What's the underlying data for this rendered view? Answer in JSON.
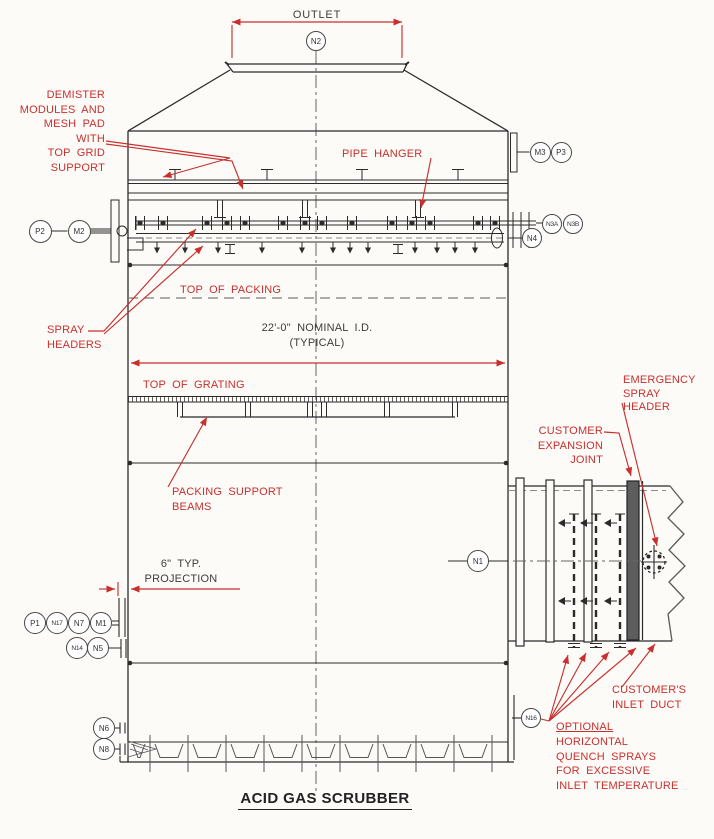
{
  "title": "ACID GAS SCRUBBER",
  "labels": {
    "outlet": "OUTLET",
    "demister": "DEMISTER\nMODULES AND\nMESH PAD\nWITH\nTOP GRID\nSUPPORT",
    "pipe_hanger": "PIPE HANGER",
    "top_of_packing": "TOP OF PACKING",
    "spray_headers": "SPRAY\nHEADERS",
    "nominal_id": "22'-0\" NOMINAL I.D.",
    "typical": "(TYPICAL)",
    "top_of_grating": "TOP OF GRATING",
    "packing_support_beams": "PACKING SUPPORT\nBEAMS",
    "projection": "6\" TYP.\nPROJECTION",
    "emergency_spray_header": "EMERGENCY\nSPRAY\nHEADER",
    "customer_expansion_joint": "CUSTOMER\nEXPANSION\nJOINT",
    "customers_inlet_duct": "CUSTOMER'S\nINLET DUCT",
    "optional_title": "OPTIONAL",
    "optional_rest": "HORIZONTAL\nQUENCH SPRAYS\nFOR EXCESSIVE\nINLET TEMPERATURE"
  },
  "nozzle_tags": [
    {
      "id": "N2",
      "x": 316,
      "y": 41,
      "r": 10
    },
    {
      "id": "M3",
      "x": 540,
      "y": 152,
      "r": 10.5
    },
    {
      "id": "P3",
      "x": 561,
      "y": 152,
      "r": 10.5
    },
    {
      "id": "P2",
      "x": 40,
      "y": 231,
      "r": 11.5
    },
    {
      "id": "M2",
      "x": 79,
      "y": 231,
      "r": 11.5
    },
    {
      "id": "N3A",
      "x": 552,
      "y": 224,
      "r": 10
    },
    {
      "id": "N3B",
      "x": 573,
      "y": 224,
      "r": 10
    },
    {
      "id": "N4",
      "x": 532,
      "y": 238,
      "r": 10
    },
    {
      "id": "N1",
      "x": 478,
      "y": 561,
      "r": 11
    },
    {
      "id": "P1",
      "x": 35,
      "y": 623,
      "r": 11
    },
    {
      "id": "N17",
      "x": 57,
      "y": 623,
      "r": 11
    },
    {
      "id": "N7",
      "x": 79,
      "y": 623,
      "r": 11
    },
    {
      "id": "M1",
      "x": 101,
      "y": 623,
      "r": 11
    },
    {
      "id": "N14",
      "x": 77,
      "y": 648,
      "r": 11
    },
    {
      "id": "N5",
      "x": 98,
      "y": 648,
      "r": 11
    },
    {
      "id": "N6",
      "x": 104,
      "y": 728,
      "r": 11
    },
    {
      "id": "N8",
      "x": 104,
      "y": 749,
      "r": 11
    },
    {
      "id": "N16",
      "x": 531,
      "y": 718,
      "r": 10
    }
  ],
  "colors": {
    "annotation_red": "#c8302e",
    "line_black": "#2b2b2b",
    "centerline_gray": "#666666"
  }
}
